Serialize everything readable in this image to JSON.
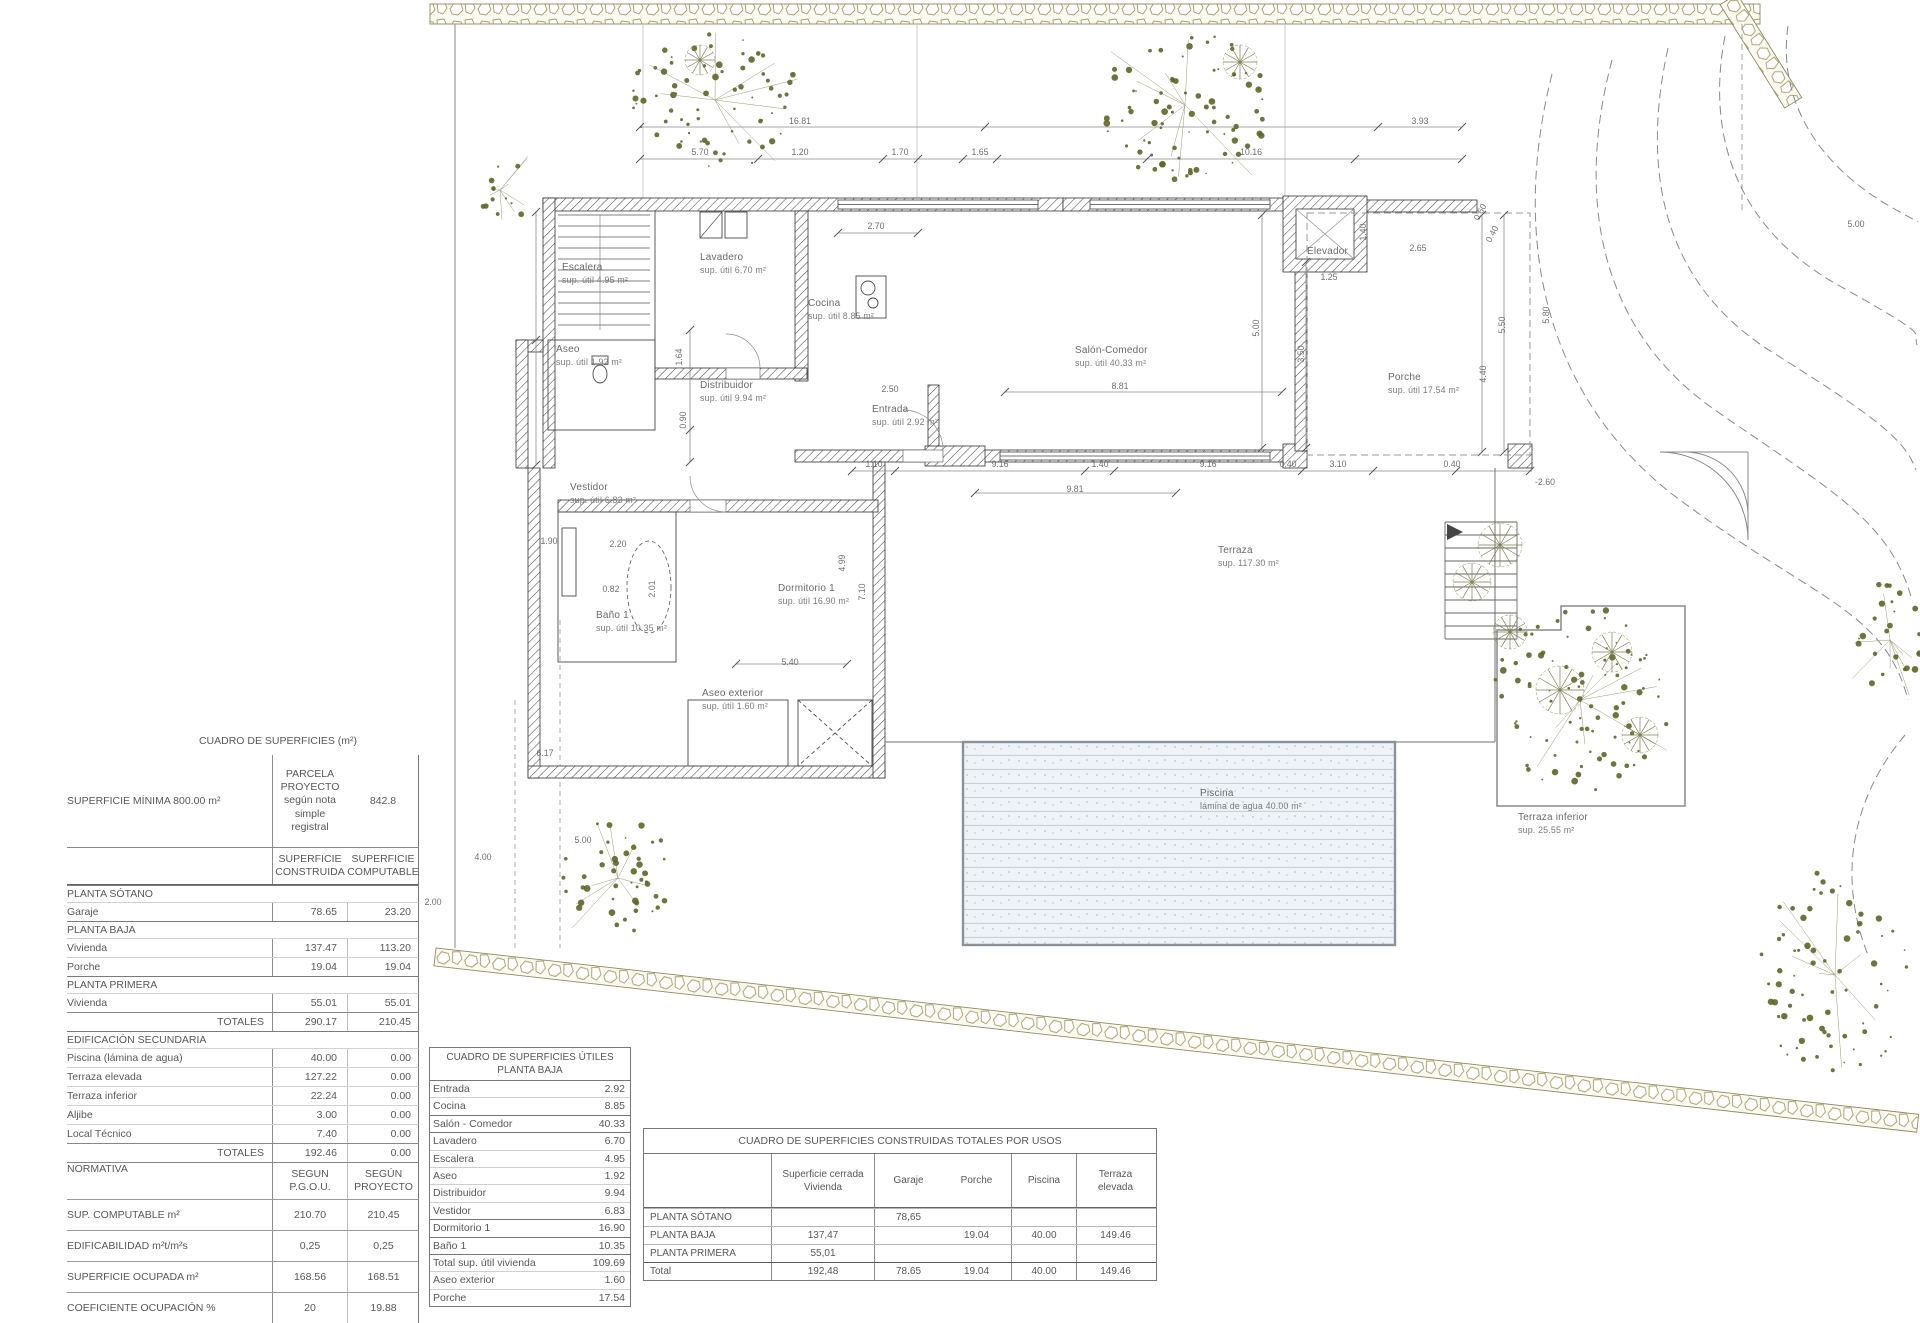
{
  "tables": {
    "superficies": {
      "title": "CUADRO DE SUPERFICIES (m²)",
      "parcela": {
        "label": "SUPERFICIE MÍNIMA 800.00 m²",
        "col1": "PARCELA\nPROYECTO\nsegún nota\nsimple\nregistral",
        "col2": "842.8"
      },
      "col_headers": [
        "SUPERFICIE\nCONSTRUIDA",
        "SUPERFICIE\nCOMPUTABLE"
      ],
      "rows": [
        {
          "type": "sec",
          "label": "PLANTA SÓTANO",
          "c1": "",
          "c2": ""
        },
        {
          "type": "data",
          "label": "Garaje",
          "c1": "78.65",
          "c2": "23.20"
        },
        {
          "type": "sec",
          "label": "PLANTA BAJA",
          "c1": "",
          "c2": ""
        },
        {
          "type": "data",
          "label": "Vivienda",
          "c1": "137.47",
          "c2": "113.20"
        },
        {
          "type": "data",
          "label": "Porche",
          "c1": "19.04",
          "c2": "19.04"
        },
        {
          "type": "sec",
          "label": "PLANTA PRIMERA",
          "c1": "",
          "c2": ""
        },
        {
          "type": "data",
          "label": "Vivienda",
          "c1": "55.01",
          "c2": "55.01"
        },
        {
          "type": "total",
          "label": "TOTALES",
          "c1": "290.17",
          "c2": "210.45"
        },
        {
          "type": "sec",
          "label": "EDIFICACIÓN SECUNDARIA",
          "c1": "",
          "c2": ""
        },
        {
          "type": "data",
          "label": "Piscina (lámina de agua)",
          "c1": "40.00",
          "c2": "0.00"
        },
        {
          "type": "data",
          "label": "Terraza elevada",
          "c1": "127.22",
          "c2": "0.00"
        },
        {
          "type": "data",
          "label": "Terraza inferior",
          "c1": "22.24",
          "c2": "0.00"
        },
        {
          "type": "data",
          "label": "Aljibe",
          "c1": "3.00",
          "c2": "0.00"
        },
        {
          "type": "data",
          "label": "Local Técnico",
          "c1": "7.40",
          "c2": "0.00"
        },
        {
          "type": "total",
          "label": "TOTALES",
          "c1": "192.46",
          "c2": "0.00"
        },
        {
          "type": "norm",
          "label": "NORMATIVA",
          "c1": "SEGUN\nP.G.O.U.",
          "c2": "SEGÚN\nPROYECTO"
        },
        {
          "type": "data2",
          "label": "SUP. COMPUTABLE    m²",
          "c1": "210.70",
          "c2": "210.45"
        },
        {
          "type": "data2",
          "label": "EDIFICABILIDAD   m²t/m²s",
          "c1": "0,25",
          "c2": "0,25"
        },
        {
          "type": "data2",
          "label": "SUPERFICIE OCUPADA   m²",
          "c1": "168.56",
          "c2": "168.51"
        },
        {
          "type": "data2",
          "label": "COEFICIENTE OCUPACIÓN  %",
          "c1": "20",
          "c2": "19.88"
        }
      ]
    },
    "utiles": {
      "title": "CUADRO DE SUPERFICIES ÚTILES\nPLANTA BAJA",
      "rows": [
        {
          "label": "Entrada",
          "v": "2.92"
        },
        {
          "label": "Cocina",
          "v": "8.85"
        },
        {
          "label": "Salón - Comedor",
          "v": "40.33"
        },
        {
          "label": "Lavadero",
          "v": "6.70"
        },
        {
          "label": "Escalera",
          "v": "4.95"
        },
        {
          "label": "Aseo",
          "v": "1.92"
        },
        {
          "label": "Distribuidor",
          "v": "9.94"
        },
        {
          "label": "Vestidor",
          "v": "6.83"
        },
        {
          "label": "Dormitorio 1",
          "v": "16.90"
        },
        {
          "label": "Baño 1",
          "v": "10.35"
        },
        {
          "label": "Total sup. útil vivienda",
          "v": "109.69"
        },
        {
          "label": "Aseo exterior",
          "v": "1.60"
        },
        {
          "label": "Porche",
          "v": "17.54"
        }
      ],
      "dark_after": [
        1,
        2,
        7,
        8,
        9
      ]
    },
    "usos": {
      "title": "CUADRO DE SUPERFICIES CONSTRUIDAS TOTALES POR USOS",
      "col_headers": [
        "Superficie cerrada\nVivienda",
        "Garaje",
        "Porche",
        "Piscina",
        "Terraza\nelevada"
      ],
      "rows": [
        {
          "label": "PLANTA SÓTANO",
          "vivienda": "",
          "garaje": "78,65",
          "porche": "",
          "piscina": "",
          "terraza": ""
        },
        {
          "label": "PLANTA BAJA",
          "vivienda": "137,47",
          "garaje": "",
          "porche": "19.04",
          "piscina": "40.00",
          "terraza": "149.46"
        },
        {
          "label": "PLANTA PRIMERA",
          "vivienda": "55,01",
          "garaje": "",
          "porche": "",
          "piscina": "",
          "terraza": ""
        },
        {
          "label": "Total",
          "vivienda": "192,48",
          "garaje": "78.65",
          "porche": "19.04",
          "piscina": "40.00",
          "terraza": "149.46",
          "total": true
        }
      ]
    }
  },
  "plan": {
    "rooms": [
      {
        "name": "Escalera",
        "sub": "sup. útil 4.95 m²",
        "x": 562,
        "y": 262
      },
      {
        "name": "Aseo",
        "sub": "sup. útil 1.92 m²",
        "x": 556,
        "y": 344
      },
      {
        "name": "Lavadero",
        "sub": "sup. útil 6.70 m²",
        "x": 700,
        "y": 252
      },
      {
        "name": "Cocina",
        "sub": "sup. útil 8.85 m²",
        "x": 808,
        "y": 298
      },
      {
        "name": "Distribuidor",
        "sub": "sup. útil 9.94 m²",
        "x": 700,
        "y": 380
      },
      {
        "name": "Entrada",
        "sub": "sup. útil 2.92 m²",
        "x": 872,
        "y": 404
      },
      {
        "name": "Salón-Comedor",
        "sub": "sup. útil 40.33 m²",
        "x": 1075,
        "y": 345
      },
      {
        "name": "Elevador",
        "sub": "",
        "x": 1307,
        "y": 246
      },
      {
        "name": "Porche",
        "sub": "sup. útil 17.54 m²",
        "x": 1388,
        "y": 372
      },
      {
        "name": "Vestidor",
        "sub": "sup. útil 6.83 m²",
        "x": 570,
        "y": 482
      },
      {
        "name": "Baño 1",
        "sub": "sup. útil 10.35 m²",
        "x": 596,
        "y": 610
      },
      {
        "name": "Dormitorio 1",
        "sub": "sup. útil 16.90 m²",
        "x": 778,
        "y": 583
      },
      {
        "name": "Aseo exterior",
        "sub": "sup. útil 1.60 m²",
        "x": 702,
        "y": 688
      },
      {
        "name": "Terraza",
        "sub": "sup. 117.30 m²",
        "x": 1218,
        "y": 545
      },
      {
        "name": "Piscina",
        "sub": "lámina de agua 40.00 m²",
        "x": 1200,
        "y": 788
      },
      {
        "name": "Terraza inferior",
        "sub": "sup. 25.55 m²",
        "x": 1518,
        "y": 812
      }
    ],
    "dimensions": [
      {
        "t": "16.81",
        "x": 800,
        "y": 121,
        "r": 0
      },
      {
        "t": "3.93",
        "x": 1420,
        "y": 121,
        "r": 0
      },
      {
        "t": "5.70",
        "x": 700,
        "y": 152,
        "r": 0
      },
      {
        "t": "1.20",
        "x": 800,
        "y": 152,
        "r": 0
      },
      {
        "t": "1.70",
        "x": 900,
        "y": 152,
        "r": 0
      },
      {
        "t": "1.65",
        "x": 980,
        "y": 152,
        "r": 0
      },
      {
        "t": "10.16",
        "x": 1251,
        "y": 152,
        "r": 0
      },
      {
        "t": "5.00",
        "x": 1856,
        "y": 224,
        "r": 0
      },
      {
        "t": "2.70",
        "x": 876,
        "y": 226,
        "r": 0
      },
      {
        "t": "1.40",
        "x": 1363,
        "y": 232,
        "r": -90
      },
      {
        "t": "2.65",
        "x": 1418,
        "y": 248,
        "r": 0
      },
      {
        "t": "1.25",
        "x": 1329,
        "y": 277,
        "r": 0
      },
      {
        "t": "0.60",
        "x": 1480,
        "y": 212,
        "r": -62
      },
      {
        "t": "0.40",
        "x": 1492,
        "y": 234,
        "r": -62
      },
      {
        "t": "5.00",
        "x": 1256,
        "y": 328,
        "r": -90
      },
      {
        "t": "3.50",
        "x": 1301,
        "y": 354,
        "r": -90
      },
      {
        "t": "5.50",
        "x": 1502,
        "y": 325,
        "r": -90
      },
      {
        "t": "4.40",
        "x": 1483,
        "y": 374,
        "r": -90
      },
      {
        "t": "5.80",
        "x": 1546,
        "y": 315,
        "r": -90
      },
      {
        "t": "8.81",
        "x": 1120,
        "y": 386,
        "r": 0
      },
      {
        "t": "2.50",
        "x": 890,
        "y": 389,
        "r": 0
      },
      {
        "t": "1.10",
        "x": 874,
        "y": 464,
        "r": 0
      },
      {
        "t": "9.16",
        "x": 1000,
        "y": 464,
        "r": 0
      },
      {
        "t": "1.40",
        "x": 1100,
        "y": 464,
        "r": 0
      },
      {
        "t": "9.16",
        "x": 1208,
        "y": 464,
        "r": 0
      },
      {
        "t": "0.40",
        "x": 1288,
        "y": 464,
        "r": 0
      },
      {
        "t": "3.10",
        "x": 1338,
        "y": 464,
        "r": 0
      },
      {
        "t": "0.40",
        "x": 1452,
        "y": 464,
        "r": 0
      },
      {
        "t": "9.81",
        "x": 1075,
        "y": 489,
        "r": 0
      },
      {
        "t": "-2.60",
        "x": 1545,
        "y": 482,
        "r": 0
      },
      {
        "t": "1.64",
        "x": 679,
        "y": 357,
        "r": -90
      },
      {
        "t": "0.90",
        "x": 683,
        "y": 420,
        "r": -90
      },
      {
        "t": "1.90",
        "x": 549,
        "y": 541,
        "r": 0
      },
      {
        "t": "2.20",
        "x": 618,
        "y": 544,
        "r": 0
      },
      {
        "t": "0.82",
        "x": 611,
        "y": 589,
        "r": 0
      },
      {
        "t": "2.01",
        "x": 652,
        "y": 589,
        "r": -90
      },
      {
        "t": "4.99",
        "x": 842,
        "y": 563,
        "r": -90
      },
      {
        "t": "7.10",
        "x": 862,
        "y": 592,
        "r": -90
      },
      {
        "t": "5.40",
        "x": 790,
        "y": 662,
        "r": 0
      },
      {
        "t": "6.17",
        "x": 545,
        "y": 753,
        "r": 0
      },
      {
        "t": "5.00",
        "x": 583,
        "y": 840,
        "r": 0
      },
      {
        "t": "4.00",
        "x": 483,
        "y": 857,
        "r": 0
      },
      {
        "t": "2.00",
        "x": 433,
        "y": 902,
        "r": 0
      }
    ]
  }
}
